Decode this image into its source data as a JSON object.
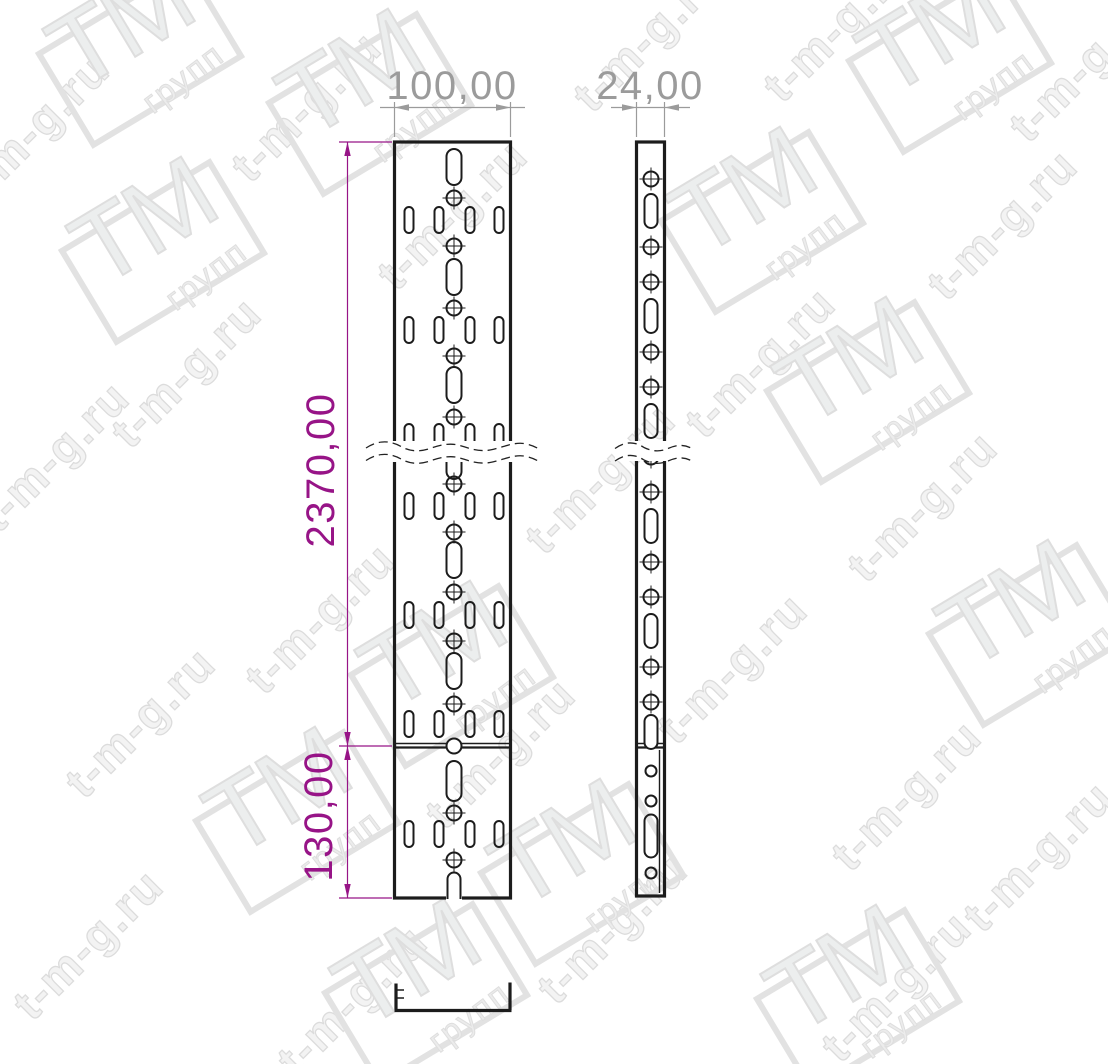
{
  "drawing": {
    "front_view": {
      "width_label": "100,00",
      "length_label": "2370,00",
      "bottom_section_label": "130,00"
    },
    "side_view": {
      "width_label": "24,00"
    }
  },
  "watermark": {
    "url_text": "t-m-g.ru",
    "logo_main": "ТМ",
    "logo_sub": "групп",
    "text_positions": [
      {
        "x": 34,
        "y": 128,
        "r": -45
      },
      {
        "x": 306,
        "y": 106,
        "r": -45
      },
      {
        "x": 648,
        "y": 36,
        "r": -45
      },
      {
        "x": 838,
        "y": 26,
        "r": -45
      },
      {
        "x": 1084,
        "y": 66,
        "r": -45
      },
      {
        "x": 1002,
        "y": 224,
        "r": -45
      },
      {
        "x": 452,
        "y": 214,
        "r": -45
      },
      {
        "x": 186,
        "y": 372,
        "r": -45
      },
      {
        "x": 760,
        "y": 362,
        "r": -45
      },
      {
        "x": 54,
        "y": 456,
        "r": -45
      },
      {
        "x": 600,
        "y": 478,
        "r": -45
      },
      {
        "x": 922,
        "y": 506,
        "r": -45
      },
      {
        "x": 320,
        "y": 618,
        "r": -45
      },
      {
        "x": 732,
        "y": 668,
        "r": -45
      },
      {
        "x": 140,
        "y": 722,
        "r": -45
      },
      {
        "x": 500,
        "y": 753,
        "r": -45
      },
      {
        "x": 906,
        "y": 795,
        "r": -45
      },
      {
        "x": 1038,
        "y": 856,
        "r": -45
      },
      {
        "x": 88,
        "y": 944,
        "r": -45
      },
      {
        "x": 612,
        "y": 928,
        "r": -45
      },
      {
        "x": 352,
        "y": 1000,
        "r": -45
      },
      {
        "x": 896,
        "y": 986,
        "r": -45
      }
    ],
    "logo_positions": [
      {
        "x": 140,
        "y": 55,
        "r": -31
      },
      {
        "x": 370,
        "y": 104,
        "r": -31
      },
      {
        "x": 950,
        "y": 62,
        "r": -31
      },
      {
        "x": 762,
        "y": 222,
        "r": -31
      },
      {
        "x": 163,
        "y": 252,
        "r": -31
      },
      {
        "x": 868,
        "y": 392,
        "r": -31
      },
      {
        "x": 452,
        "y": 676,
        "r": -31
      },
      {
        "x": 1030,
        "y": 635,
        "r": -31
      },
      {
        "x": 297,
        "y": 822,
        "r": -31
      },
      {
        "x": 582,
        "y": 874,
        "r": -31
      },
      {
        "x": 426,
        "y": 994,
        "r": -31
      },
      {
        "x": 858,
        "y": 1000,
        "r": -31
      }
    ]
  },
  "colors": {
    "line_black": "#1c1c1c",
    "dimension_gray": "#9b9b9b",
    "dimension_magenta": "#971487",
    "watermark_gray": "#dcdcdc"
  }
}
